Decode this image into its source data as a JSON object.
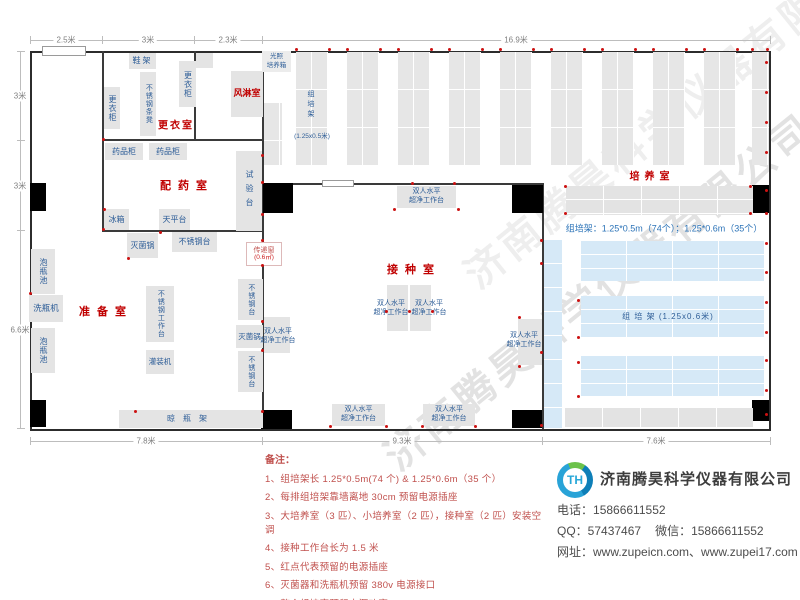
{
  "plan": {
    "dims": {
      "top": [
        "2.5米",
        "3米",
        "2.3米",
        "16.9米"
      ],
      "left": [
        "3米",
        "3米",
        "6.6米"
      ],
      "bottom": [
        "7.8米",
        "9.3米",
        "7.6米"
      ]
    },
    "rooms": {
      "changing": "更衣室",
      "air_shower": "风淋室",
      "dispensing": "配药室",
      "prep": "准备室",
      "inoculation": "接种室",
      "culture": "培养室"
    },
    "equipment": {
      "shoe_rack": "鞋架",
      "locker": "更衣柜",
      "ss_bench": "不锈钢条凳",
      "light_incubator": "光照\n培养箱",
      "medicine_cabinet": "药品柜",
      "test_bench": "试验台",
      "fridge": "冰箱",
      "balance_table": "天平台",
      "sterilizer": "灭菌锅",
      "ss_table": "不锈钢台",
      "pass_window": "传递窗",
      "pass_window_size": "(0.6㎡)",
      "soak_pool": "泡瓶池",
      "bottle_washer": "洗瓶机",
      "ss_workbench": "不锈钢工作台",
      "filling_machine": "灌装机",
      "drying_rack": "晾瓶架",
      "clean_bench": "双人水平\n超净工作台"
    },
    "racks": {
      "culture_rack_label": "组培架",
      "culture_rack_size_small": "(1.25x0.5米)",
      "culture_rack_size_big": "组 培 架 (1.25x0.6米)",
      "spec_line": "组培架：1.25*0.5m（74个）；1.25*0.6m（35个）"
    }
  },
  "notes": {
    "title": "备注：",
    "items": [
      "1、组培架长 1.25*0.5m(74 个) & 1.25*0.6m（35 个）",
      "2、每排组培架靠墙离地 30cm 预留电源插座",
      "3、大培养室（3 匹）、小培养室（2 匹），接种室（2 匹）安装空调",
      "4、接种工作台长为 1.5 米",
      "5、红点代表预留的电源插座",
      "6、灭菌器和洗瓶机预留 380v 电源接口",
      "7、整个组培室预留电源功率 > 300kw",
      "8、培养室推拉门地轨和地面一平，方便小推车推送。"
    ]
  },
  "company": {
    "logo_text": "TH",
    "name": "济南腾昊科学仪器有限公司",
    "phone_label": "电话：",
    "phone": "15866611552",
    "qq_label": "QQ：",
    "qq": "57437467",
    "wechat_label": "微信：",
    "wechat": "15866611552",
    "web_label": "网址：",
    "web": "www.zupeicn.com、www.zupei17.com"
  },
  "watermark": "济南腾昊科学仪器有限公司"
}
